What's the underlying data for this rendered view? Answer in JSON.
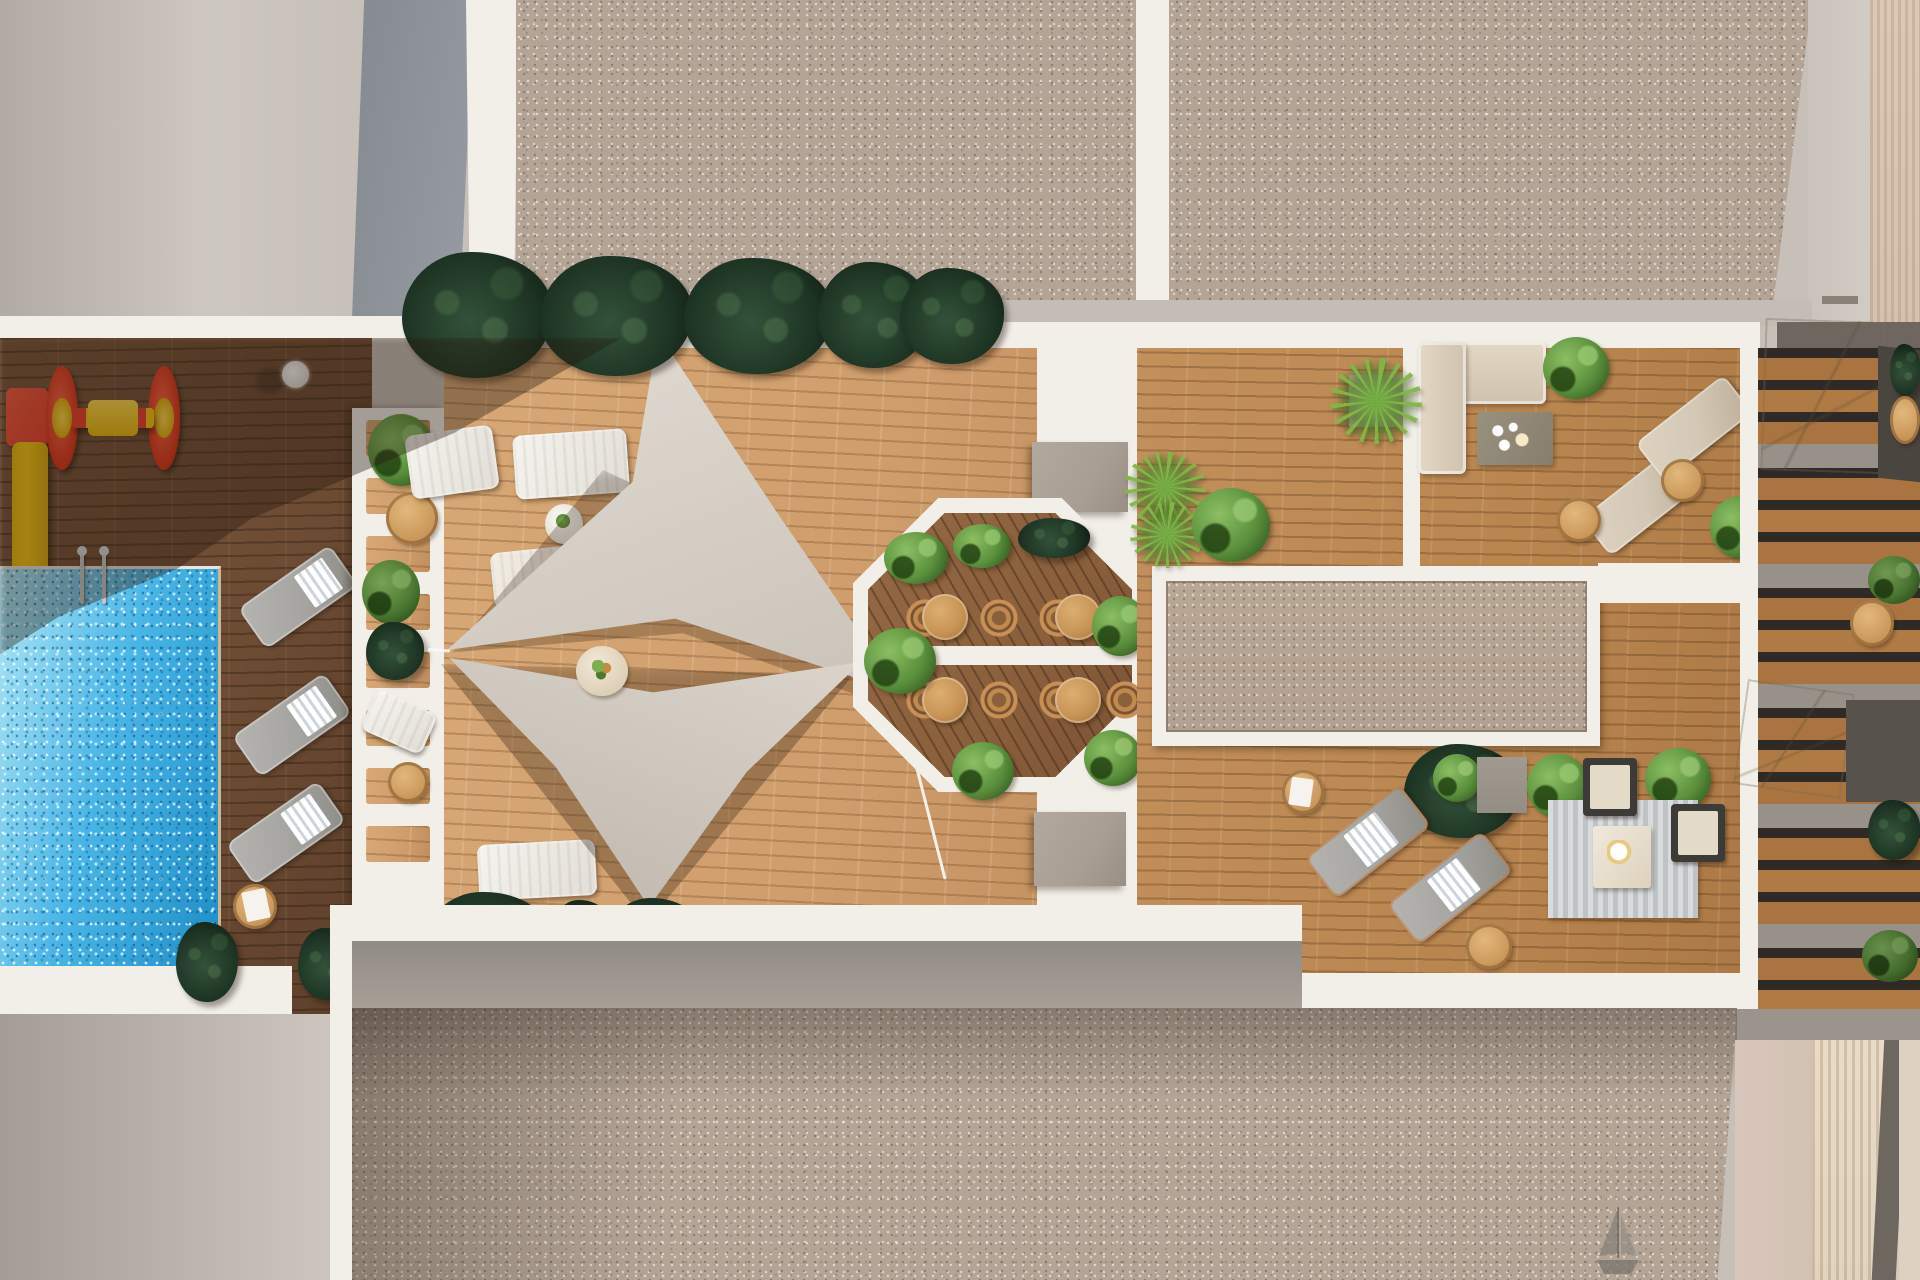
{
  "scene": {
    "type": "architectural-aerial-render",
    "view": "top-down",
    "setting": "residential rooftop amenity terrace with swimming pool, sun decks, shade sails, octagonal dining patio, lounge areas and private side terraces",
    "text_content": "none (image contains no readable text)"
  },
  "colors": {
    "wall_gray": "#c7c0b9",
    "wall_shade": "#8b9097",
    "gravel": "#b3a496",
    "white": "#f2efe9",
    "wood_dark": "#6e4c34",
    "wood_light": "#cf9d6b",
    "wood_mid": "#b9854f",
    "wood_oct": "#8a5f3c",
    "pool_light": "#aee6f4",
    "pool_blue": "#49b5e6",
    "pool_deep": "#1f8ec7",
    "sail": "#d6cfc6",
    "plant_dark": "#1d3323",
    "plant_bright": "#5a8f3c",
    "rattan": "#c08a4d",
    "table_tan": "#c79455",
    "slide_red": "#e8402e",
    "slide_yellow": "#f5c614",
    "lounger_gray": "#a5a4a0",
    "lounger_beige": "#d3c7b5",
    "sand_beige": "#d2c2b3",
    "concrete": "#98918a",
    "concrete_block": "#a89e93"
  },
  "inventory": {
    "swimming_pool": 1,
    "pool_ladder": 1,
    "playground": {
      "slide": 1,
      "roller_spinner_toy": 1
    },
    "shade_sails": 2,
    "sail_anchor_ball": 1,
    "pergola_trellis_cells": 8,
    "octagonal_dining_patio": {
      "bistro_tables": 4,
      "rattan_chairs": 8,
      "shrubs": 7
    },
    "sun_loungers": {
      "pool_side_gray": 3,
      "deck_white": 4,
      "upper_terrace_beige": 2,
      "lower_terrace_gray": 2
    },
    "l_shaped_sofa": 1,
    "coffee_tables": 2,
    "armchairs": 2,
    "striped_rug": 1,
    "round_side_tables": 8,
    "gray_planter_blocks": 2,
    "gravel_skylight_panel": 1,
    "private_side_terraces": 5,
    "beige_canopies": 2,
    "sailboat_motif": 1,
    "plant_clusters": {
      "dark_tropical": 12,
      "bright_shrubs": 12,
      "yucca": 3
    }
  },
  "regions": [
    "upper gravel roof",
    "upper left wall",
    "pool deck with playground",
    "swimming pool",
    "white trellis walkway",
    "light wood sun deck with shade sails",
    "octagonal dining patio",
    "central gravel skylight",
    "upper lounge with sofa",
    "lower lounge with rug and armchairs",
    "private cascading terraces right",
    "lower gravel roof",
    "sand colored lower right roof"
  ]
}
